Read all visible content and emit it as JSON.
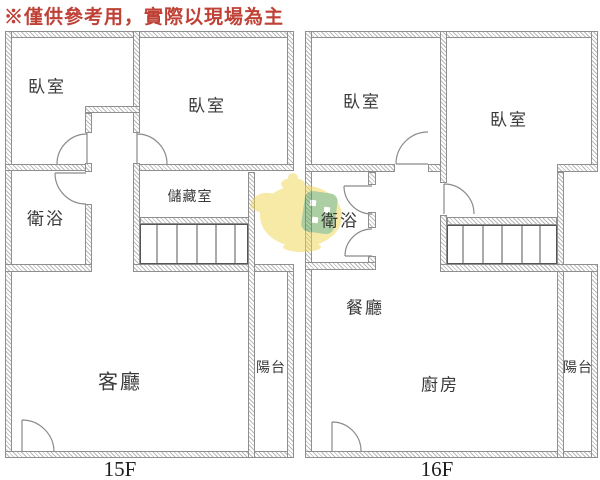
{
  "disclaimer": "※僅供參考用，實際以現場為主",
  "colors": {
    "disclaimer_text": "#bf4136",
    "wall_line": "#8f8f8f",
    "label_text": "#3a3a3a",
    "watermark_yellow": "#f0d54f",
    "watermark_green": "#5a9e4a"
  },
  "plans": [
    {
      "floor_label": "15F",
      "rooms": {
        "bedroom_left": "臥室",
        "bedroom_right": "臥室",
        "bathroom": "衛浴",
        "storage": "儲藏室",
        "living_room": "客廳",
        "balcony": "陽台"
      }
    },
    {
      "floor_label": "16F",
      "rooms": {
        "bedroom_left": "臥室",
        "bedroom_right": "臥室",
        "bathroom": "衛浴",
        "dining": "餐廳",
        "kitchen": "廚房",
        "balcony": "陽台"
      }
    }
  ]
}
